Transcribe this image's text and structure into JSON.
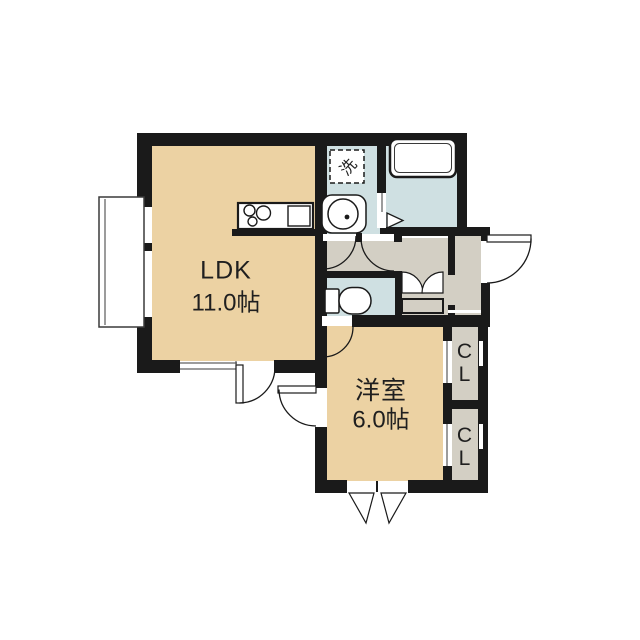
{
  "title": "1LDK floor plan",
  "colors": {
    "bg": "#ffffff",
    "wall": "#1a1a1a",
    "line": "#3a3a3a",
    "text": "#1f1f1f",
    "room": "#ecd2a3",
    "wet": "#cfe0e2",
    "hall": "#d3cfc4"
  },
  "rooms": {
    "ldk": {
      "label": "LDK",
      "area": "11.0帖"
    },
    "western": {
      "label": "洋室",
      "area": "6.0帖"
    },
    "closet_top": {
      "label": "CL"
    },
    "closet_bottom": {
      "label": "CL"
    },
    "laundry": {
      "label": "洗"
    }
  }
}
